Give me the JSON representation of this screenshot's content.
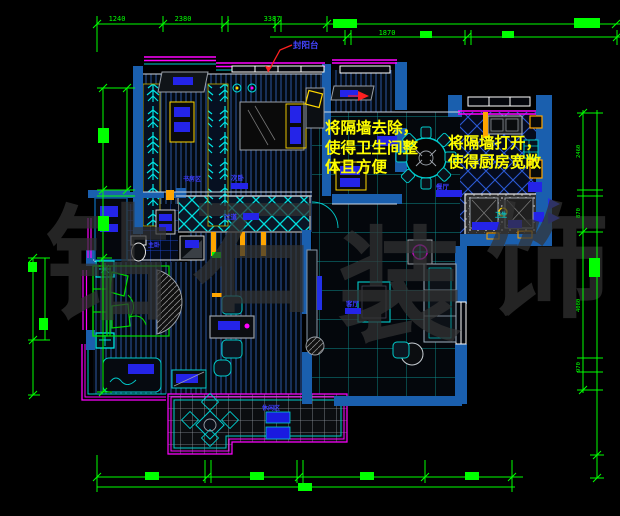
{
  "canvas": {
    "width": 620,
    "height": 516,
    "background": "#000000"
  },
  "watermark": {
    "char1": "钻",
    "char2": "石",
    "char3": "装",
    "char4": "饰",
    "color": "#333333"
  },
  "annotations": {
    "bathroom_note": {
      "line1": "将隔墙去除，",
      "line2": "使得卫生间整",
      "line3": "体且方便"
    },
    "kitchen_note": {
      "line1": "将隔墙打开，",
      "line2": "使得厨房宽敞"
    },
    "balcony_label": "封阳台"
  },
  "room_labels": {
    "study": "书房区",
    "bedroom2": "次卧",
    "corridor": "过道",
    "master": "主卧",
    "dining": "餐厅",
    "living": "客厅",
    "bathroom": "卫生",
    "leisure": "休闲区"
  },
  "dimensions": {
    "top1": "1240",
    "top2": "2380",
    "top3": "3387",
    "top_inner": "1870",
    "right1": "2460",
    "right2": "870",
    "right3": "4080",
    "right4": "970"
  },
  "colors": {
    "dimension": "#00ff00",
    "wall": "#1a5fae",
    "outline": "#00e5e5",
    "magenta": "#ff00ff",
    "note_yellow": "#ffff00",
    "furniture_blue": "#2424e8",
    "leader_red": "#ff2020",
    "label_blue": "#3b3bff"
  }
}
